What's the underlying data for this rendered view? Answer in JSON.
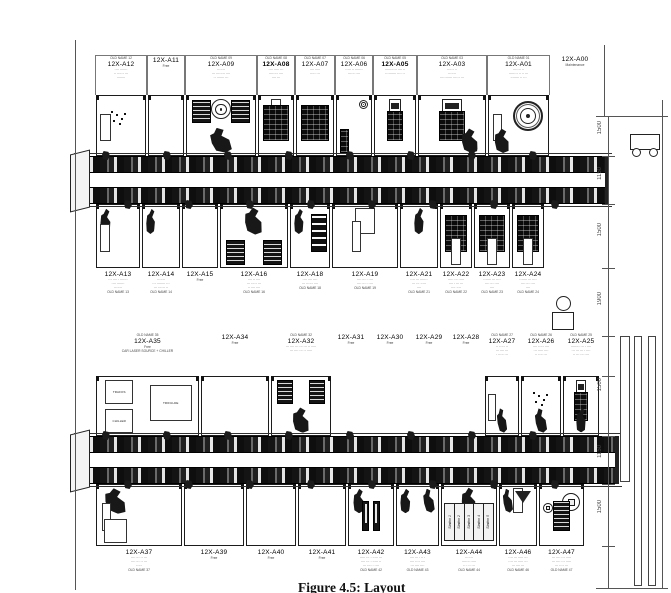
{
  "caption": "Figure 4.5: Layout",
  "colors": {
    "ink": "#1a1a1a",
    "paper": "#ffffff",
    "line": "#555555"
  },
  "rows": [
    {
      "name": "line1-top",
      "labels": {
        "y": 55,
        "h": 40,
        "pos": "above",
        "bordered": true
      },
      "box": {
        "y": 95,
        "h": 61
      },
      "x0": 95,
      "stations": [
        {
          "id": "12X-A12",
          "w": 52,
          "old": "OLD NAME 12",
          "sub": [
            "···· ·······",
            "·· ······ ···",
            "········"
          ],
          "glyphs": [
            {
              "t": "panelw",
              "p": "ml"
            },
            {
              "t": "dots",
              "p": "mc"
            }
          ]
        },
        {
          "id": "12X-A11",
          "w": 38,
          "sub": [
            "Free"
          ],
          "glyphs": []
        },
        {
          "id": "12X-A09",
          "w": 72,
          "old": "OLD NAME 09",
          "sub": [
            "·······",
            "··· ········ ····",
            "·· ······· ···"
          ],
          "glyphs": [
            {
              "t": "coil",
              "p": "tc"
            },
            {
              "t": "fixture",
              "p": "tl"
            },
            {
              "t": "fixture",
              "p": "tr"
            },
            {
              "t": "robot",
              "p": "bc"
            }
          ]
        },
        {
          "id": "12X-A08",
          "w": 38,
          "bold": true,
          "old": "OLD NAME 08",
          "sub": [
            "···· ····· ···",
            "········ ····",
            "···· ···"
          ],
          "glyphs": [
            {
              "t": "panelw",
              "p": "tc"
            },
            {
              "t": "cabinet",
              "p": "fill"
            }
          ]
        },
        {
          "id": "12X-A07",
          "w": 40,
          "old": "OLD NAME 07",
          "sub": [
            "···· ·····",
            "····· ···"
          ],
          "glyphs": [
            {
              "t": "cabinet",
              "p": "fill"
            }
          ]
        },
        {
          "id": "12X-A06",
          "w": 38,
          "old": "OLD NAME 06",
          "sub": [
            "····· ·· ·······",
            "······ ····"
          ],
          "glyphs": [
            {
              "t": "coil",
              "p": "tr"
            },
            {
              "t": "cabinet",
              "p": "bl"
            }
          ]
        },
        {
          "id": "12X-A05",
          "w": 44,
          "bold": true,
          "old": "OLD NAME 05",
          "sub": [
            "··········· ···· ··",
            "·········· ···· ··"
          ],
          "glyphs": [
            {
              "t": "screen",
              "p": "tc"
            },
            {
              "t": "cabinet",
              "p": "mc"
            }
          ]
        },
        {
          "id": "12X-A03",
          "w": 70,
          "old": "OLD NAME 03",
          "sub": [
            "······ ··",
            "·······",
            "··········· ······ ···"
          ],
          "glyphs": [
            {
              "t": "screen",
              "p": "tc"
            },
            {
              "t": "cabinet",
              "p": "mc"
            },
            {
              "t": "robot",
              "p": "br"
            }
          ]
        },
        {
          "id": "12X-A01",
          "w": 63,
          "old": "OLD NAME 01",
          "sub": [
            "······· ··",
            "········ ·· ·· ···",
            "········ ·· ···"
          ],
          "glyphs": [
            {
              "t": "slot",
              "p": "ml"
            },
            {
              "t": "bigcoil",
              "p": "big"
            },
            {
              "t": "robot",
              "p": "bl"
            }
          ]
        },
        {
          "id": "12X-A00",
          "w": 50,
          "sub": [
            "Maintenance"
          ],
          "boxed": false,
          "bordered": false,
          "glyphs": []
        }
      ]
    },
    {
      "name": "line1-bottom",
      "labels": {
        "y": 270,
        "h": 56,
        "pos": "below"
      },
      "box": {
        "y": 204,
        "h": 64
      },
      "x0": 95,
      "stations": [
        {
          "id": "12X-A13",
          "w": 46,
          "sub": [
            "··· ···· · ·······",
            "···· ·······",
            "·······",
            "OLD NAME 13"
          ],
          "glyphs": [
            {
              "t": "robot",
              "p": "tl"
            },
            {
              "t": "panelw",
              "p": "ml"
            }
          ]
        },
        {
          "id": "12X-A14",
          "w": 40,
          "sub": [
            "·······",
            "··· ········ ···",
            "··· ······ ··",
            "OLD NAME 14"
          ],
          "glyphs": [
            {
              "t": "robot",
              "p": "tl"
            }
          ]
        },
        {
          "id": "12X-A15",
          "w": 38,
          "sub": [
            "Free"
          ],
          "glyphs": []
        },
        {
          "id": "12X-A16",
          "w": 70,
          "sub": [
            "···· ·· ····",
            "··· ····· ···",
            "·· ···· ····",
            "OLD NAME 16"
          ],
          "glyphs": [
            {
              "t": "robot",
              "p": "tc"
            },
            {
              "t": "fixture",
              "p": "bl"
            },
            {
              "t": "fixture",
              "p": "br"
            }
          ]
        },
        {
          "id": "12X-A18",
          "w": 42,
          "sub": [
            "···· ···· ····",
            "··· ······ ····",
            "OLD NAME 18"
          ],
          "glyphs": [
            {
              "t": "robot",
              "p": "tl"
            },
            {
              "t": "cabstack",
              "p": "mr"
            }
          ]
        },
        {
          "id": "12X-A19",
          "w": 68,
          "sub": [
            "···· ··· · ····",
            "···· ··· · ····",
            "OLD NAME 19"
          ],
          "glyphs": [
            {
              "t": "panelw",
              "p": "tc"
            },
            {
              "t": "slot",
              "p": "mc"
            }
          ]
        },
        {
          "id": "12X-A21",
          "w": 40,
          "sub": [
            "···· ··· ·······",
            "··· ··· ·····",
            "····",
            "OLD NAME 21"
          ],
          "glyphs": [
            {
              "t": "robot",
              "p": "tc"
            }
          ]
        },
        {
          "id": "12X-A22",
          "w": 34,
          "sub": [
            "····· ··· ·····",
            "···· · ··· ···",
            "···· ····",
            "OLD NAME 22"
          ],
          "glyphs": [
            {
              "t": "cabinet",
              "p": "fill"
            },
            {
              "t": "panelw",
              "p": "bc"
            }
          ]
        },
        {
          "id": "12X-A23",
          "w": 38,
          "sub": [
            "······· ··· ····",
            "···· ··· ····",
            "····",
            "OLD NAME 23"
          ],
          "glyphs": [
            {
              "t": "cabinet",
              "p": "fill"
            },
            {
              "t": "panelw",
              "p": "bc"
            }
          ]
        },
        {
          "id": "12X-A24",
          "w": 34,
          "sub": [
            "······· ··· ····",
            "···· ··· ····",
            "····",
            "OLD NAME 24"
          ],
          "glyphs": [
            {
              "t": "cabinet",
              "p": "fill"
            },
            {
              "t": "panelw",
              "p": "bc"
            }
          ]
        }
      ]
    },
    {
      "name": "line2-top",
      "labels": {
        "y": 333,
        "h": 43,
        "pos": "above"
      },
      "box": {
        "y": 376,
        "h": 60
      },
      "x0": 95,
      "stations": [
        {
          "id": "12X-A35",
          "w": 105,
          "old": "OLD NAME 35",
          "sub": [
            "Free",
            "CAR LASER SOURCE + CHILLER"
          ],
          "glyphs": [
            {
              "t": "room",
              "p": "tl",
              "label": "TRAFOS"
            },
            {
              "t": "room",
              "p": "bl",
              "label": "CHILLER"
            },
            {
              "t": "room",
              "p": "mr",
              "label": "TRIFULDE"
            }
          ]
        },
        {
          "id": "12X-A34",
          "w": 70,
          "sub": [
            "Free"
          ],
          "glyphs": []
        },
        {
          "id": "12X-A32",
          "w": 62,
          "old": "OLD NAME 32",
          "sub": [
            "··· ···· ··· ··· ··· ·· ·····",
            "··· ···· ··· ·· ·····"
          ],
          "glyphs": [
            {
              "t": "fixture",
              "p": "tl"
            },
            {
              "t": "fixture",
              "p": "tr"
            },
            {
              "t": "robot",
              "p": "bc"
            }
          ]
        },
        {
          "id": "12X-A31",
          "w": 38,
          "sub": [
            "Free"
          ],
          "boxed": false,
          "glyphs": []
        },
        {
          "id": "12X-A30",
          "w": 40,
          "sub": [
            "Free"
          ],
          "boxed": false,
          "glyphs": []
        },
        {
          "id": "12X-A29",
          "w": 38,
          "sub": [
            "Free"
          ],
          "boxed": false,
          "glyphs": []
        },
        {
          "id": "12X-A28",
          "w": 36,
          "sub": [
            "Free"
          ],
          "boxed": false,
          "glyphs": []
        },
        {
          "id": "12X-A27",
          "w": 36,
          "old": "OLD NAME 27",
          "sub": [
            "·· ····· ··",
            "··· ···· ···",
            "· ····· ···"
          ],
          "glyphs": [
            {
              "t": "slot",
              "p": "ml"
            },
            {
              "t": "robot",
              "p": "bc"
            }
          ]
        },
        {
          "id": "12X-A26",
          "w": 42,
          "old": "OLD NAME 26",
          "sub": [
            "···· ····· ····",
            "··· ····· ····",
            "·· ···· ···"
          ],
          "glyphs": [
            {
              "t": "dots",
              "p": "mc"
            },
            {
              "t": "robot",
              "p": "bc"
            }
          ]
        },
        {
          "id": "12X-A25",
          "w": 38,
          "old": "OLD NAME 25",
          "sub": [
            "········ ··· · ····",
            "··· ··· ··· · ····",
            "·· ··· ··· ····"
          ],
          "glyphs": [
            {
              "t": "screen",
              "p": "tc"
            },
            {
              "t": "cabinet",
              "p": "mc"
            },
            {
              "t": "robot",
              "p": "bc"
            }
          ]
        }
      ]
    },
    {
      "name": "line2-bottom",
      "labels": {
        "y": 548,
        "h": 42,
        "pos": "below"
      },
      "box": {
        "y": 484,
        "h": 62
      },
      "x0": 95,
      "stations": [
        {
          "id": "12X-A37",
          "w": 88,
          "sub": [
            "···· ··· ·· ···",
            "···· ··· ·· ···",
            "·····",
            "OLD NAME 37"
          ],
          "glyphs": [
            {
              "t": "robot",
              "p": "tl"
            },
            {
              "t": "slot",
              "p": "ml"
            },
            {
              "t": "panelw",
              "p": "bl"
            }
          ]
        },
        {
          "id": "12X-A39",
          "w": 62,
          "sub": [
            "Free"
          ],
          "glyphs": []
        },
        {
          "id": "12X-A40",
          "w": 52,
          "sub": [
            "Free"
          ],
          "glyphs": []
        },
        {
          "id": "12X-A41",
          "w": 50,
          "sub": [
            "Free"
          ],
          "glyphs": []
        },
        {
          "id": "12X-A42",
          "w": 48,
          "sub": [
            "····· ··· · ····· ···",
            "···· ··· · ····· ··",
            "··· ···· · ····",
            "OLD NAME 42"
          ],
          "glyphs": [
            {
              "t": "robot",
              "p": "tl"
            },
            {
              "t": "towers",
              "p": "mc"
            }
          ]
        },
        {
          "id": "12X-A43",
          "w": 45,
          "sub": [
            "···· ··· · ·· ·",
            "···· ···· ····",
            "··· ···· ····",
            "OLD NAME 43"
          ],
          "glyphs": [
            {
              "t": "robot",
              "p": "tl"
            },
            {
              "t": "robot",
              "p": "tr"
            }
          ]
        },
        {
          "id": "12X-A44",
          "w": 58,
          "sub": [
            "·······",
            "······· ·····",
            "·· · ·· ···",
            "OLD NAME 44"
          ],
          "glyphs": [
            {
              "t": "robot",
              "p": "tc"
            },
            {
              "t": "stations",
              "p": "low",
              "labels": [
                "Station 1",
                "Station 2",
                "Station 3",
                "Station 4",
                "Station 5"
              ]
            }
          ]
        },
        {
          "id": "12X-A46",
          "w": 40,
          "sub": [
            "···· ··· ····· ···",
            "···· ··· ····· ···",
            "··· ···· ···",
            "OLD NAME 46"
          ],
          "glyphs": [
            {
              "t": "funnel",
              "p": "tc"
            },
            {
              "t": "robot",
              "p": "tl"
            }
          ]
        },
        {
          "id": "12X-A47",
          "w": 47,
          "sub": [
            "··· ···· ··· ·····",
            "··· ···· ··· ·····",
            "··· ···· ···",
            "OLD NAME 47"
          ],
          "glyphs": [
            {
              "t": "tank",
              "p": "ml"
            },
            {
              "t": "tank",
              "p": "mr"
            },
            {
              "t": "fixture",
              "p": "mc"
            }
          ]
        }
      ]
    }
  ],
  "conveyors": [
    {
      "x": 76,
      "y": 156,
      "w": 532,
      "h": 48
    },
    {
      "x": 76,
      "y": 436,
      "w": 542,
      "h": 48
    }
  ],
  "dimensions": {
    "line_x": 608,
    "far_line_x": 662,
    "ticks_y": [
      116,
      156,
      204,
      268,
      336,
      376,
      436,
      484,
      546,
      588
    ],
    "labels": [
      {
        "value": "1500",
        "y": 135
      },
      {
        "value": "1150",
        "y": 181
      },
      {
        "value": "1500",
        "y": 237
      },
      {
        "value": "1900",
        "y": 306
      },
      {
        "value": "1500",
        "y": 392
      },
      {
        "value": "1150",
        "y": 459
      },
      {
        "value": "1500",
        "y": 514
      }
    ]
  }
}
